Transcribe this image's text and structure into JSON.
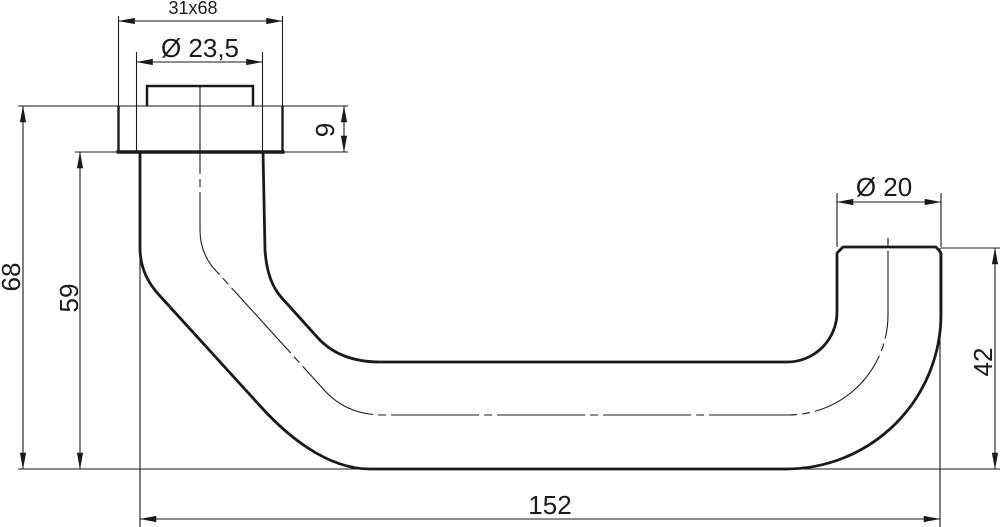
{
  "drawing": {
    "colors": {
      "line": "#1a1a1a",
      "background": "#ffffff"
    },
    "dimensions": {
      "plate_size": "31x68",
      "rose_diameter": "Ø 23,5",
      "plate_thickness": "9",
      "overall_height": "68",
      "neck_height": "59",
      "grip_diameter": "Ø 20",
      "end_height": "42",
      "overall_length": "152"
    }
  }
}
